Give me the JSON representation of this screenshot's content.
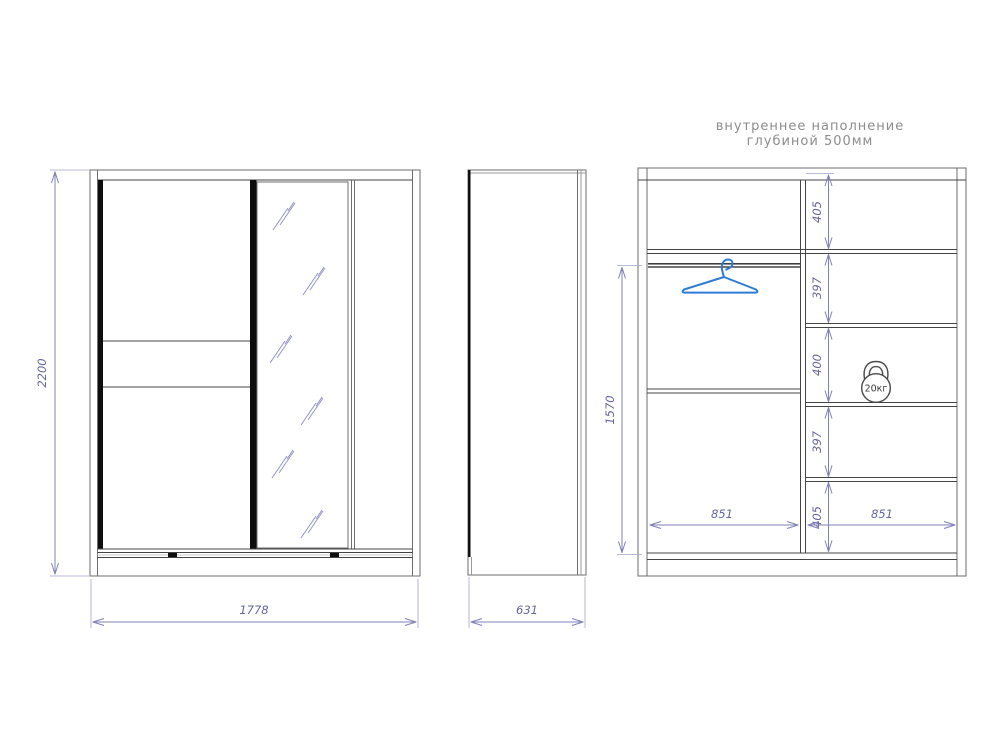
{
  "page": {
    "title_line1": "внутреннее наполнение",
    "title_line2": "глубиной 500мм"
  },
  "dims": {
    "front_height": "2200",
    "front_width": "1778",
    "side_depth": "631",
    "rod_height": "1570",
    "left_section_width": "851",
    "right_section_width": "851",
    "right_shelves": [
      "405",
      "397",
      "400",
      "397",
      "405"
    ],
    "kettlebell_label": "20кг"
  },
  "icons": {
    "hanger": "clothes-hanger-icon",
    "kettlebell": "kettlebell-20kg-icon",
    "mirror_hatch": "mirror-glass-hatch-marks"
  },
  "colors": {
    "dimension_line": "#8080b8",
    "dimension_text": "#64649f",
    "drawing_line": "#5a5a5a",
    "door_profile": "#0d0d0d",
    "hanger_blue": "#2e7cd6",
    "title_gray": "#8c8c8c",
    "background": "#ffffff"
  }
}
